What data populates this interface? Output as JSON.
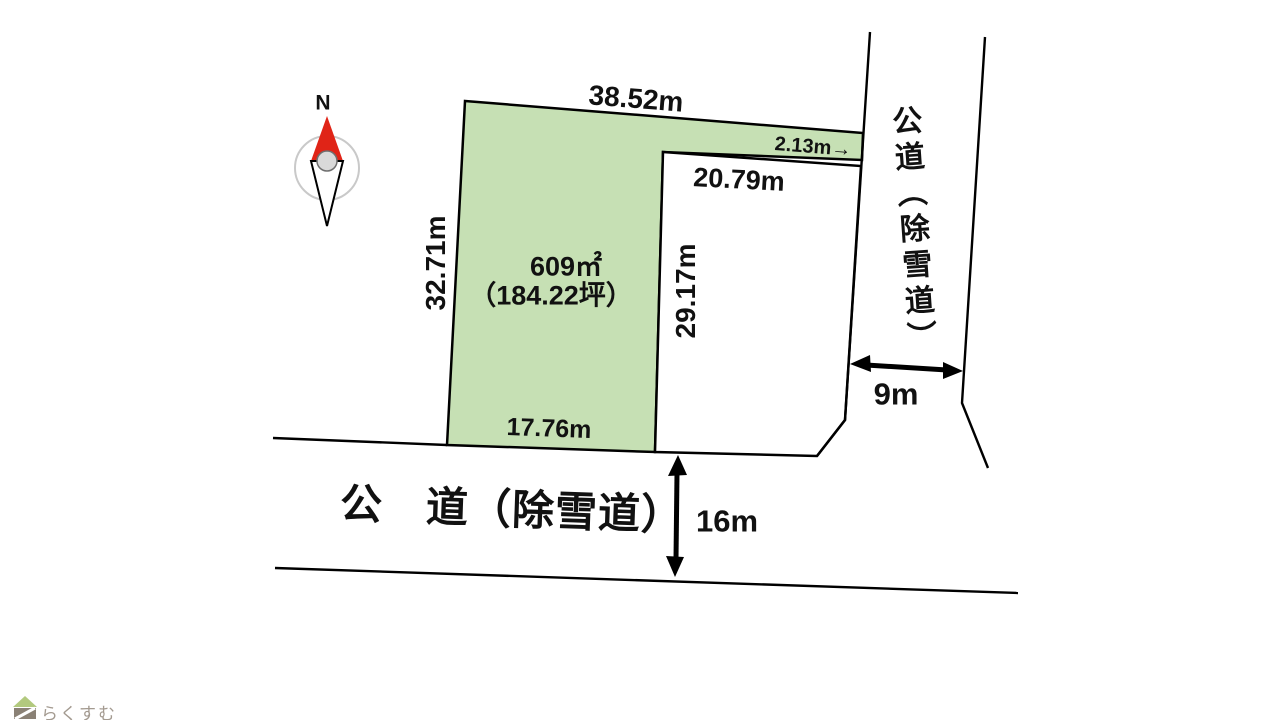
{
  "diagram": {
    "labels": {
      "dim_top": "38.52m",
      "dim_left": "32.71m",
      "area_m2": "609㎡",
      "area_tsubo": "（184.22坪）",
      "dim_right_inner": "29.17m",
      "dim_neighbor_top": "20.79m",
      "dim_strip": "2.13m",
      "dim_bottom": "17.76m",
      "road_bottom_name": "公　道（除雪道）",
      "road_bottom_width": "16m",
      "road_right_name": "公道（除雪道）",
      "road_right_width": "9m",
      "compass_north": "N"
    },
    "icons": {
      "right_arrow": "→"
    },
    "colors": {
      "plot_fill": "#c6e0b4",
      "outline": "#000000",
      "north_needle_red": "#e02417",
      "compass_ring": "#c9c9c9",
      "logo_roof_green": "#b2c97e",
      "logo_body_gray": "#8a8175",
      "logo_text_color": "#a39a90"
    }
  },
  "footer": {
    "logo_text": "らくすむ"
  }
}
